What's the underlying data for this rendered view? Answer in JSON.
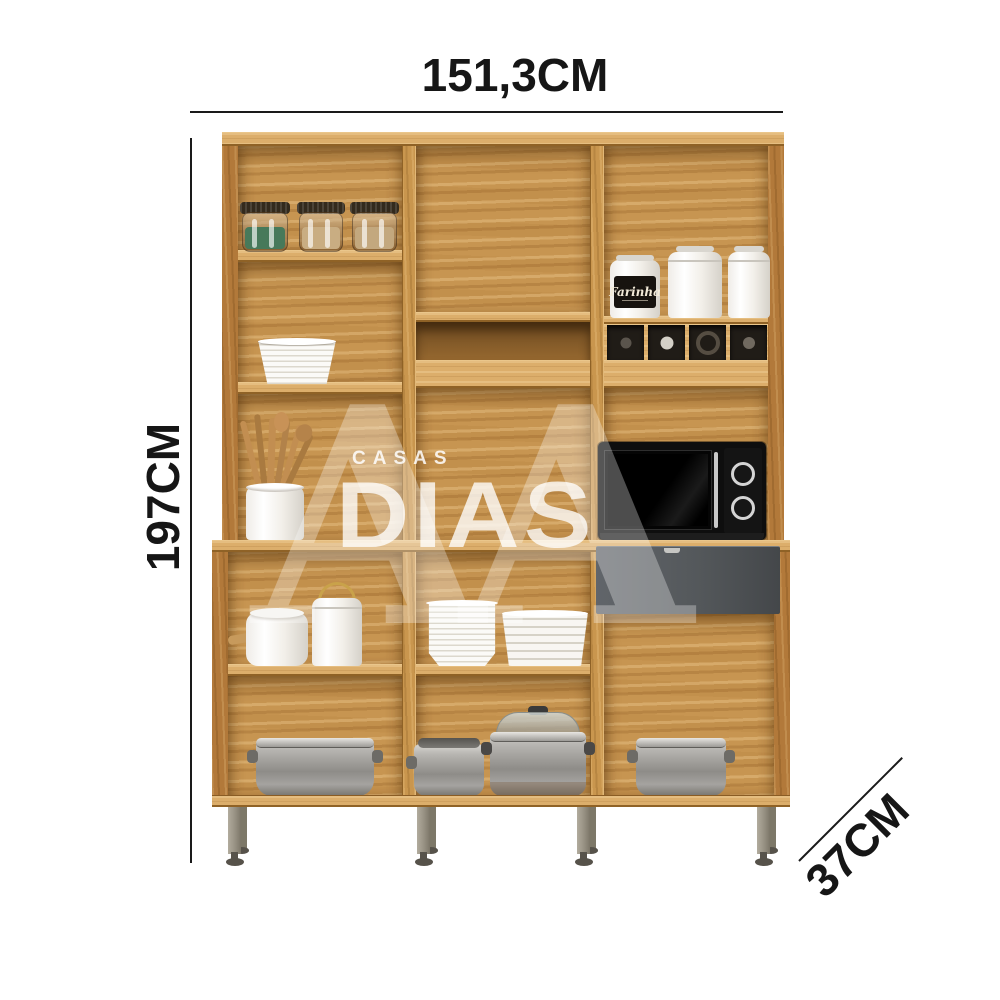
{
  "dimensions": {
    "width": "151,3CM",
    "height": "197CM",
    "depth": "37CM"
  },
  "watermark": {
    "line1": "CASAS",
    "line2": "DIAS",
    "monogram": "A"
  },
  "product": {
    "canister_label": "Farinha",
    "visible_items": [
      "spice jars",
      "stacked white plates",
      "wooden utensils in crock",
      "white kitchen canisters",
      "dark wine cubbies",
      "black microwave with two knobs",
      "graphite drawer front",
      "ceramic pots with wood and gold handles",
      "saucer stack",
      "bowl stack",
      "stainless steel pots and roasting pan",
      "metal legs"
    ]
  },
  "colors": {
    "background": "#ffffff",
    "dimension_text": "#161616",
    "dimension_line": "#1a1a1a",
    "wood_base": "#c79551",
    "wood_dark": "#b2793a",
    "wood_light": "#dcae6b",
    "wood_edge": "#8f6226",
    "drawer_gray": "#54585b",
    "microwave_black": "#0e0e0e",
    "metal_leg": "#9a9488",
    "watermark_white": "#ffffff"
  }
}
